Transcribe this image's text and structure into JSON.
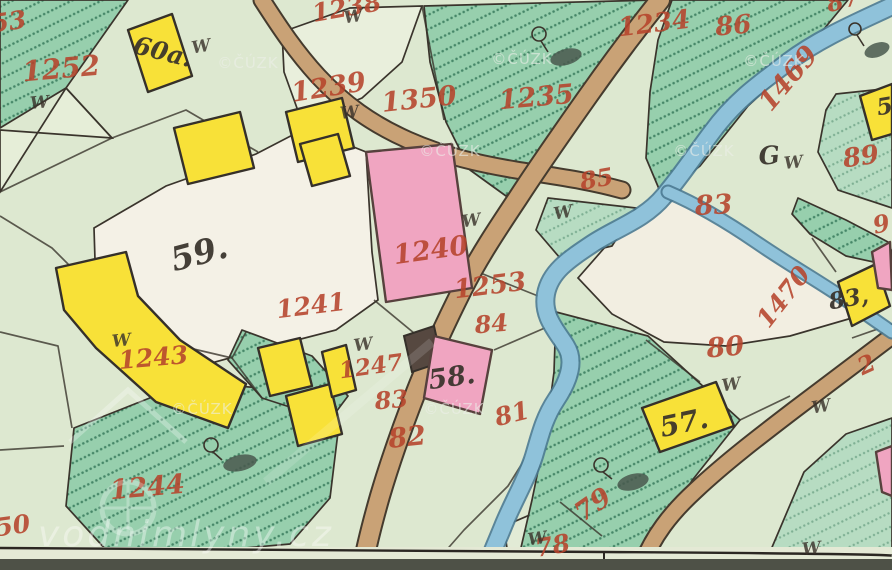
{
  "map": {
    "description_label": "historical cadastral map tile",
    "parcel_numbers": [
      {
        "text": "53",
        "x": 10,
        "y": 30,
        "rot": -8,
        "size": 25
      },
      {
        "text": "1252",
        "x": 62,
        "y": 78,
        "rot": -5,
        "size": 28
      },
      {
        "text": "1238",
        "x": 348,
        "y": 16,
        "rot": -10,
        "size": 25
      },
      {
        "text": "1239",
        "x": 330,
        "y": 96,
        "rot": -9,
        "size": 27
      },
      {
        "text": "1350",
        "x": 420,
        "y": 108,
        "rot": -6,
        "size": 27
      },
      {
        "text": "1235",
        "x": 537,
        "y": 106,
        "rot": -5,
        "size": 27
      },
      {
        "text": "1234",
        "x": 655,
        "y": 32,
        "rot": -7,
        "size": 26
      },
      {
        "text": "86",
        "x": 734,
        "y": 34,
        "rot": -5,
        "size": 26
      },
      {
        "text": "87",
        "x": 845,
        "y": 8,
        "rot": -15,
        "size": 24
      },
      {
        "text": "1469",
        "x": 795,
        "y": 84,
        "rot": -50,
        "size": 27
      },
      {
        "text": "85",
        "x": 598,
        "y": 187,
        "rot": -10,
        "size": 24
      },
      {
        "text": "83",
        "x": 714,
        "y": 214,
        "rot": -3,
        "size": 27
      },
      {
        "text": "89",
        "x": 862,
        "y": 165,
        "rot": -8,
        "size": 26
      },
      {
        "text": "1240",
        "x": 432,
        "y": 259,
        "rot": -8,
        "size": 27
      },
      {
        "text": "1253",
        "x": 491,
        "y": 294,
        "rot": -7,
        "size": 26
      },
      {
        "text": "84",
        "x": 492,
        "y": 332,
        "rot": -5,
        "size": 24
      },
      {
        "text": "1241",
        "x": 312,
        "y": 314,
        "rot": -7,
        "size": 25
      },
      {
        "text": "9",
        "x": 883,
        "y": 232,
        "rot": -12,
        "size": 24
      },
      {
        "text": "1470",
        "x": 790,
        "y": 302,
        "rot": -52,
        "size": 25
      },
      {
        "text": "1243",
        "x": 154,
        "y": 366,
        "rot": -5,
        "size": 25
      },
      {
        "text": "1247",
        "x": 372,
        "y": 374,
        "rot": -8,
        "size": 23
      },
      {
        "text": "83",
        "x": 392,
        "y": 408,
        "rot": -5,
        "size": 24
      },
      {
        "text": "82",
        "x": 408,
        "y": 446,
        "rot": -6,
        "size": 27
      },
      {
        "text": "81",
        "x": 514,
        "y": 422,
        "rot": -14,
        "size": 25
      },
      {
        "text": "80",
        "x": 726,
        "y": 356,
        "rot": -5,
        "size": 27
      },
      {
        "text": "79",
        "x": 598,
        "y": 512,
        "rot": -35,
        "size": 27
      },
      {
        "text": "78",
        "x": 554,
        "y": 554,
        "rot": -10,
        "size": 25
      },
      {
        "text": "1244",
        "x": 148,
        "y": 496,
        "rot": -5,
        "size": 27
      },
      {
        "text": "50",
        "x": 14,
        "y": 534,
        "rot": -8,
        "size": 25
      },
      {
        "text": "2",
        "x": 870,
        "y": 372,
        "rot": -25,
        "size": 24
      }
    ],
    "house_numbers": [
      {
        "text": "60a.",
        "x": 161,
        "y": 60,
        "rot": 14,
        "size": 25
      },
      {
        "text": "59.",
        "x": 202,
        "y": 264,
        "rot": -15,
        "size": 33
      },
      {
        "text": "58.",
        "x": 453,
        "y": 386,
        "rot": -8,
        "size": 27
      },
      {
        "text": "57.",
        "x": 686,
        "y": 432,
        "rot": -12,
        "size": 28
      },
      {
        "text": "83,",
        "x": 850,
        "y": 306,
        "rot": -10,
        "size": 23
      },
      {
        "text": "5",
        "x": 886,
        "y": 114,
        "rot": -10,
        "size": 23
      },
      {
        "text": "G",
        "x": 770,
        "y": 164,
        "rot": -5,
        "size": 25
      }
    ],
    "meadow_symbols": {
      "symbol": "W",
      "positions": [
        {
          "x": 40,
          "y": 108,
          "rot": -5
        },
        {
          "x": 202,
          "y": 52,
          "rot": -10
        },
        {
          "x": 354,
          "y": 22,
          "rot": -8
        },
        {
          "x": 350,
          "y": 118,
          "rot": -6
        },
        {
          "x": 472,
          "y": 226,
          "rot": -8
        },
        {
          "x": 564,
          "y": 218,
          "rot": -10
        },
        {
          "x": 122,
          "y": 346,
          "rot": -6
        },
        {
          "x": 364,
          "y": 350,
          "rot": -8
        },
        {
          "x": 794,
          "y": 168,
          "rot": -6
        },
        {
          "x": 732,
          "y": 390,
          "rot": -8
        },
        {
          "x": 822,
          "y": 412,
          "rot": -10
        },
        {
          "x": 538,
          "y": 544,
          "rot": -8
        },
        {
          "x": 812,
          "y": 554,
          "rot": -6
        }
      ]
    },
    "copyright_watermark": {
      "text": "©ČÚZK",
      "positions": [
        {
          "x": 248,
          "y": 68
        },
        {
          "x": 522,
          "y": 64
        },
        {
          "x": 774,
          "y": 66
        },
        {
          "x": 450,
          "y": 156
        },
        {
          "x": 704,
          "y": 156
        },
        {
          "x": 202,
          "y": 414
        },
        {
          "x": 454,
          "y": 414
        }
      ]
    },
    "brand_watermark": {
      "text": "vodnimlyny.cz"
    },
    "palette": {
      "background": "#dde8d0",
      "courtyard_cream": "#f4f1e6",
      "field_cream": "#f2eee1",
      "hatched_green": "#97cfad",
      "hatch_dot": "#2b6e51",
      "building_yellow": "#f8e138",
      "building_pink": "#f0a5c1",
      "road_tan": "#c9a276",
      "river_blue": "#8fc2da",
      "parcel_number_red": "#b6442c",
      "house_number_black": "#37312a"
    }
  }
}
